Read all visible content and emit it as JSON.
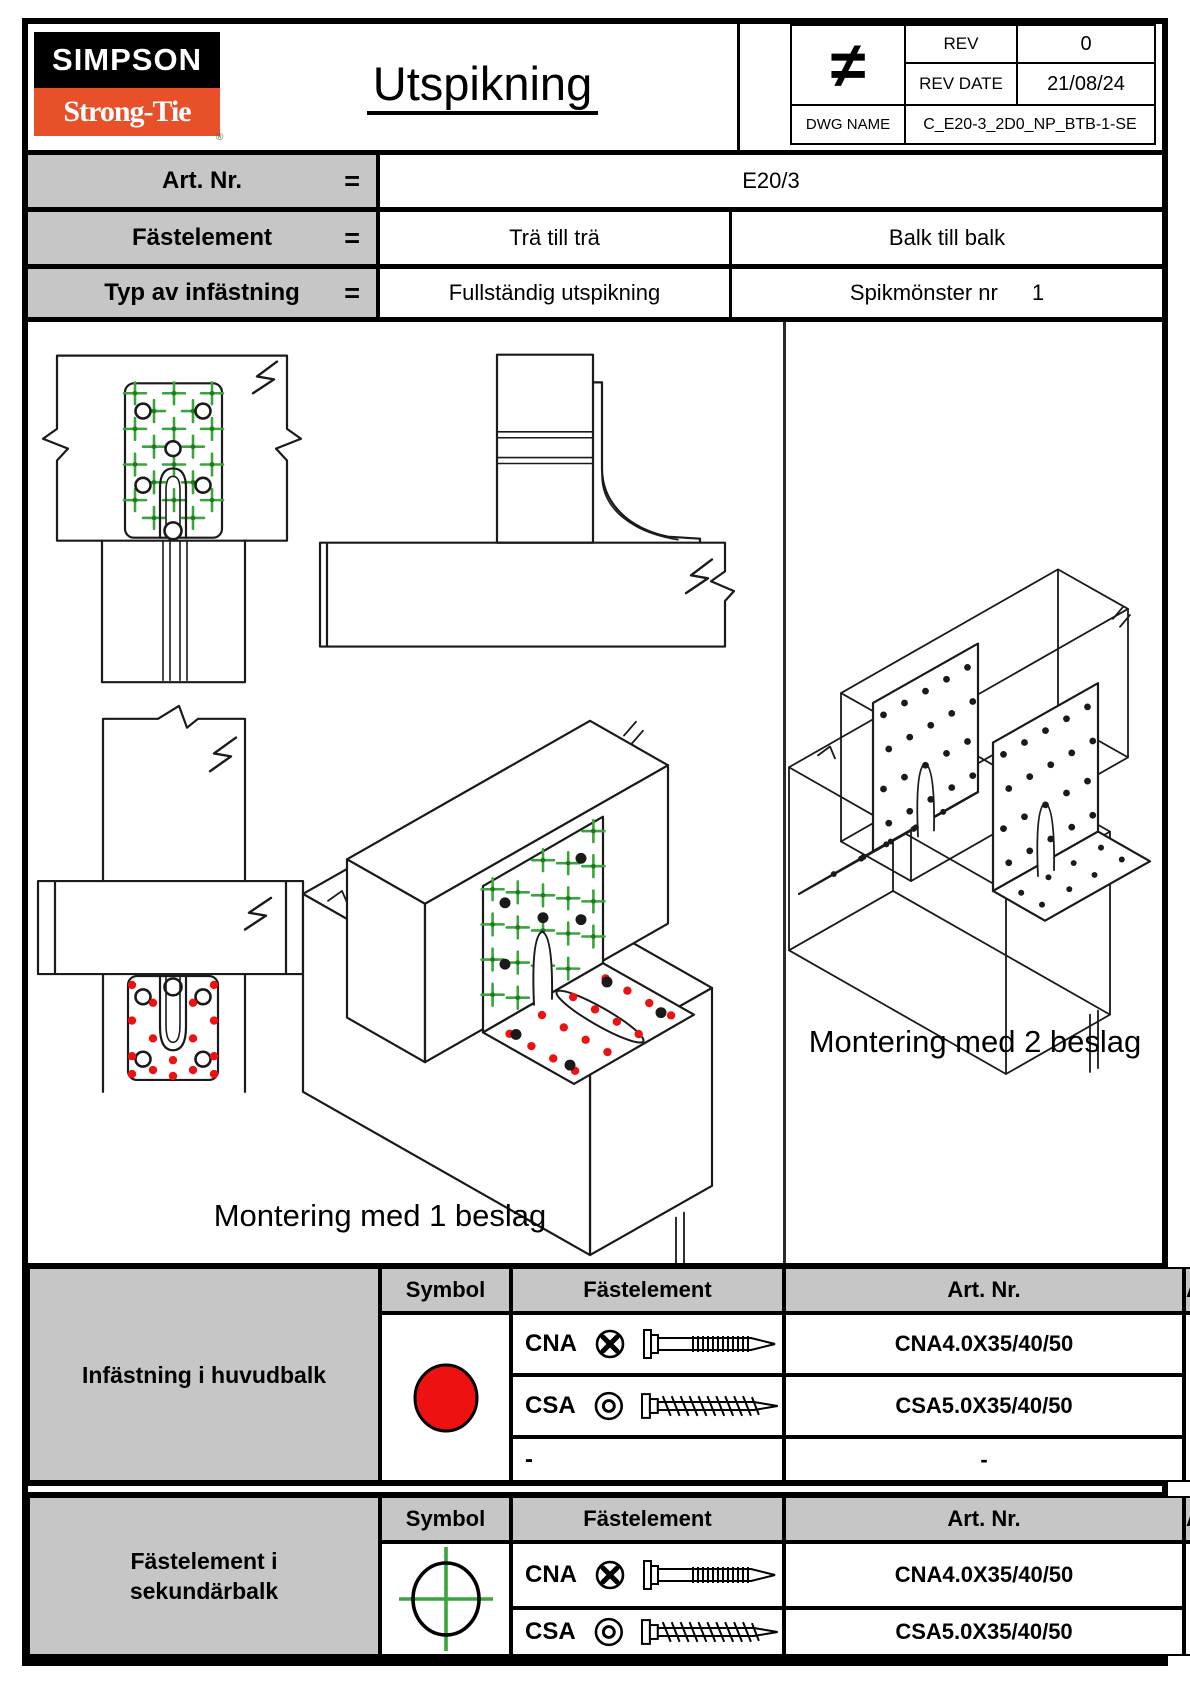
{
  "header": {
    "logo_top": "SIMPSON",
    "logo_bottom": "Strong-Tie",
    "logo_reg": "®",
    "title": "Utspikning",
    "stamp_symbol": "≠",
    "rev_label": "REV",
    "rev_value": "0",
    "rev_date_label": "REV DATE",
    "rev_date_value": "21/08/24",
    "dwg_label": "DWG NAME",
    "dwg_value": "C_E20-3_2D0_NP_BTB-1-SE"
  },
  "info": {
    "art": {
      "label": "Art. Nr.",
      "eq": "=",
      "value": "E20/3"
    },
    "fastener": {
      "label": "Fästelement",
      "eq": "=",
      "left": "Trä till trä",
      "right": "Balk till balk"
    },
    "type": {
      "label": "Typ av infästning",
      "eq": "=",
      "left": "Fullständig utspikning",
      "right": "Spikmönster nr",
      "pattern_no": "1"
    }
  },
  "drawings": {
    "caption_one": "Montering med 1 beslag",
    "caption_two": "Montering med 2 beslag",
    "nail_color_main_beam": "#ee1111",
    "nail_color_secondary_beam": "#3aa53a",
    "line_color": "#1a1a1a"
  },
  "fastener_tables": [
    {
      "title": "Infästning i huvudbalk",
      "symbol": "red-filled-circle",
      "headers": {
        "symbol": "Symbol",
        "fastener": "Fästelement",
        "art": "Art. Nr.",
        "qty": "Antal"
      },
      "rows": [
        {
          "name": "CNA",
          "art": "CNA4.0X35/40/50"
        },
        {
          "name": "CSA",
          "art": "CSA5.0X35/40/50"
        },
        {
          "name": "-",
          "art": "-"
        }
      ],
      "qty": "16"
    },
    {
      "title": "Fästelement i sekundärbalk",
      "symbol": "green-crosshair-circle",
      "headers": {
        "symbol": "Symbol",
        "fastener": "Fästelement",
        "art": "Art. Nr.",
        "qty": "Antal"
      },
      "rows": [
        {
          "name": "CNA",
          "art": "CNA4.0X35/40/50"
        },
        {
          "name": "CSA",
          "art": "CSA5.0X35/40/50"
        }
      ],
      "qty": "24"
    }
  ]
}
